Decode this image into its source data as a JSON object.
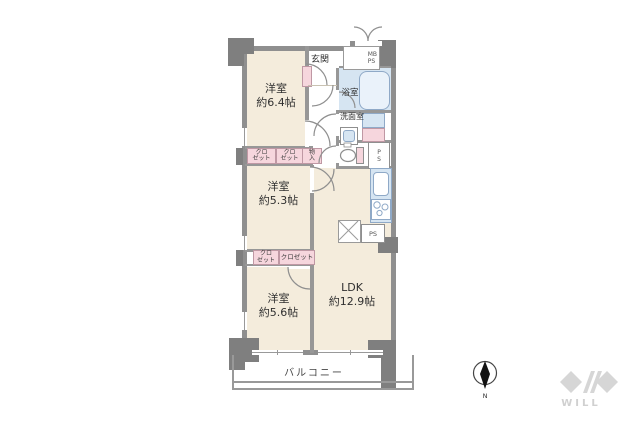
{
  "rooms": {
    "bedroom1": {
      "name": "洋室",
      "size": "約6.4帖"
    },
    "bedroom2": {
      "name": "洋室",
      "size": "約5.3帖"
    },
    "bedroom3": {
      "name": "洋室",
      "size": "約5.6帖"
    },
    "ldk": {
      "name": "LDK",
      "size": "約12.9帖"
    },
    "entrance": {
      "name": "玄関"
    },
    "bathroom": {
      "name": "浴室"
    },
    "washroom": {
      "name": "洗面室"
    },
    "balcony": {
      "name": "バルコニー"
    }
  },
  "storage": {
    "closet_r1a": {
      "line1": "クロ",
      "line2": "ゼット"
    },
    "closet_r1b": {
      "line1": "クロ",
      "line2": "ゼット"
    },
    "monoire": {
      "line1": "物",
      "line2": "入"
    },
    "closet_r2a": {
      "line1": "クロ",
      "line2": "ゼット"
    },
    "closet_r2b": {
      "name": "クロゼット"
    }
  },
  "shafts": {
    "mb_ps": {
      "line1": "MB",
      "line2": "PS"
    },
    "ps_toilet": {
      "line1": "P",
      "line2": "S"
    },
    "ps_kitchen": {
      "name": "PS"
    }
  },
  "compass": {
    "north": "N"
  },
  "branding": {
    "logo": "WILL"
  },
  "colors": {
    "wall": "#8f8f8f",
    "floor": "#f4ecdc",
    "water": "#d6e5f2",
    "accent_pink": "#f6d6dd",
    "logo_gray": "#d6d6d6"
  }
}
